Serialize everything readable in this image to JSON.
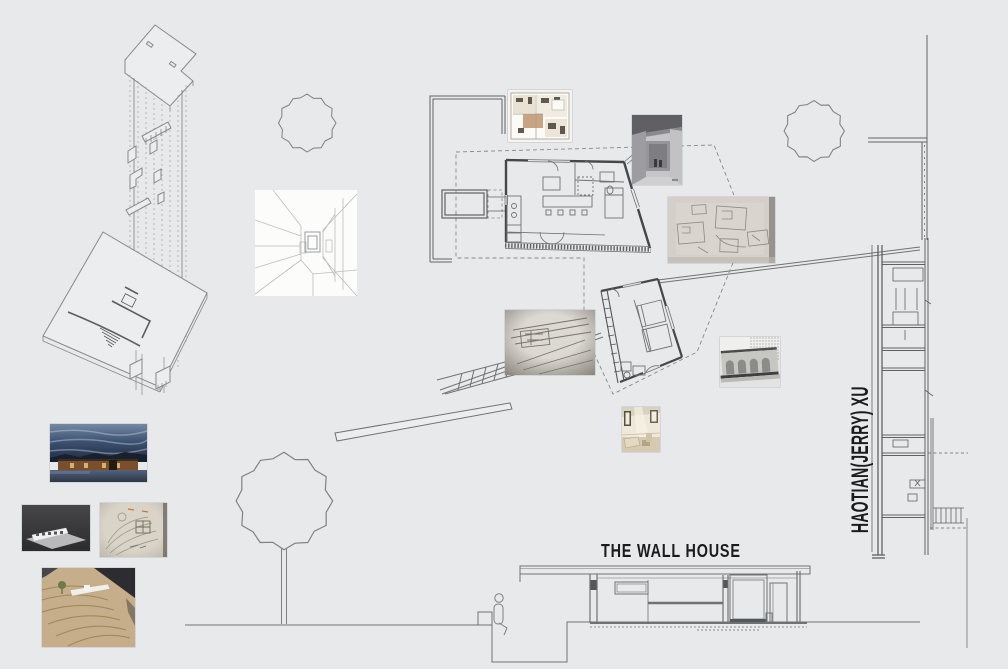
{
  "board": {
    "title": "THE WALL HOUSE",
    "author": "HAOTIAN(JERRY) XU",
    "colors": {
      "background": "#e8e9eb",
      "line": "#6f7275",
      "line-light": "#8d9194",
      "wall": "#45474a",
      "text": "#1b1b1c",
      "paper": "#fcfcfb"
    }
  }
}
